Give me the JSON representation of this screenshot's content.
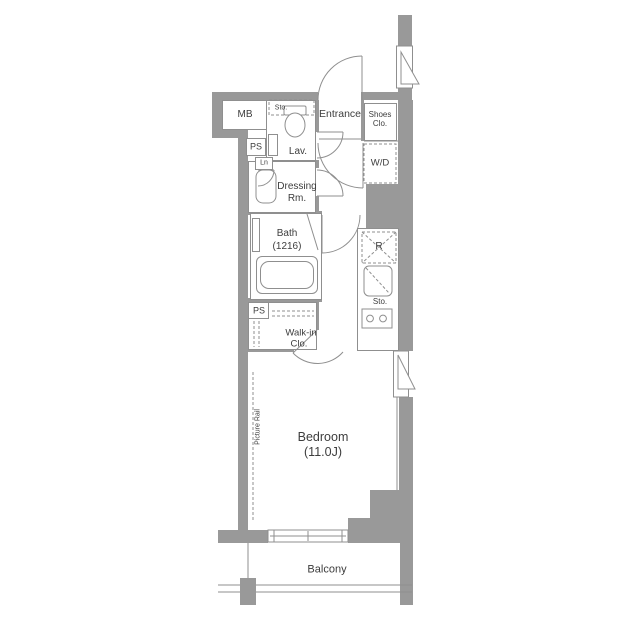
{
  "floorplan": {
    "labels": {
      "mb": "MB",
      "sto_toilet": "Sto.",
      "lav": "Lav.",
      "ps_upper": "PS",
      "ln": "Ln",
      "dressing_line1": "Dressing",
      "dressing_line2": "Rm.",
      "entrance": "Entrance",
      "shoes_line1": "Shoes",
      "shoes_line2": "Clo.",
      "wd": "W/D",
      "bath_line1": "Bath",
      "bath_line2": "(1216)",
      "ps_lower": "PS",
      "walkin_line1": "Walk-in",
      "walkin_line2": "Clo.",
      "fridge": "R",
      "sto_kitchen": "Sto.",
      "bedroom_line1": "Bedroom",
      "bedroom_line2": "(11.0J)",
      "picture_rail": "Picture Rail",
      "balcony": "Balcony"
    },
    "colors": {
      "wall": "#999999",
      "line": "#8f8f8f",
      "text": "#3d3d3d",
      "background": "#ffffff"
    },
    "fixtures": [
      "toilet",
      "washbasin",
      "bathtub",
      "washer-dryer-space",
      "refrigerator-space",
      "kitchen-sink",
      "gas-stove",
      "sliding-window",
      "casement-window",
      "door-swing",
      "hanger-rail"
    ]
  }
}
